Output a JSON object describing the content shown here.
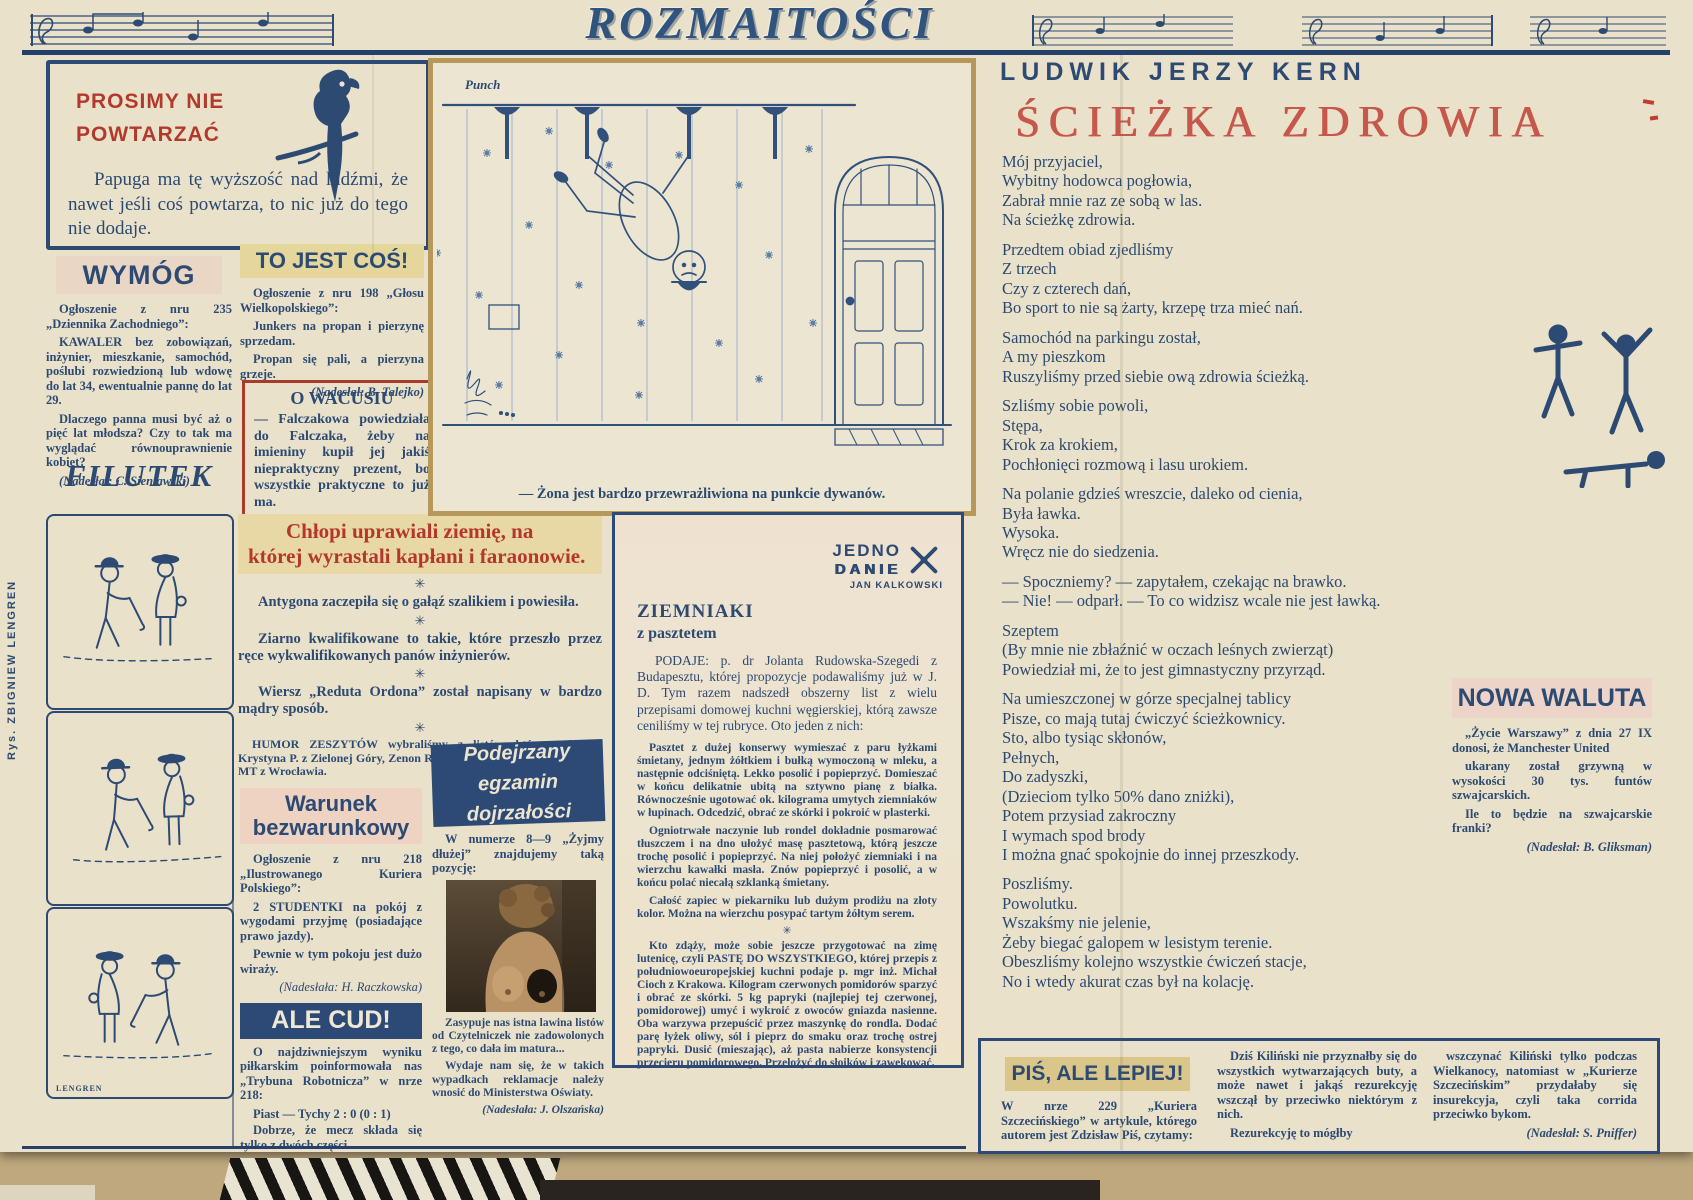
{
  "masthead": {
    "title": "ROZMAITOŚCI"
  },
  "no_repeat": {
    "title": "PROSIMY NIE\nPOWTARZAĆ",
    "body": "Papuga ma tę wyższość nad ludźmi, że nawet jeśli coś powtarza, to nic już do tego nie dodaje."
  },
  "wymog": {
    "title": "WYMÓG",
    "p1": "Ogłoszenie z nru 235 „Dziennika Zachodniego”:",
    "p2": "KAWALER bez zobowiązań, inżynier, mieszkanie, samochód, poślubi rozwiedzioną lub wdowę do lat 34, ewentualnie pannę do lat 29.",
    "p3": "Dlaczego panna musi być aż o pięć lat młodsza? Czy to tak ma wyglądać równouprawnienie kobiet?",
    "credit": "(Nadesłał: C. Sieniawski)"
  },
  "filutek": {
    "title": "FILUTEK",
    "signature": "LENGREN",
    "side_credit": "Rys. ZBIGNIEW LENGREN"
  },
  "to_jest_cos": {
    "title": "TO JEST COŚ!",
    "p1": "Ogłoszenie z nru 198 „Głosu Wielkopolskiego”:",
    "p2": "Junkers na propan i pierzynę sprzedam.",
    "p3": "Propan się pali, a pierzyna grzeje.",
    "credit": "(Nadesłał: B. Talejko)"
  },
  "o_wacusiu": {
    "title": "O WACUSIU",
    "body": "— Falczakowa powiedziała do Falczaka, żeby na imieniny kupił jej jakiś niepraktyczny prezent, bo wszystkie praktyczne to już ma."
  },
  "chlopi": {
    "title": "Chłopi uprawiali ziemię, na której wyrastali kapłani i faraonowie.",
    "star": "✳",
    "item1": "Antygona zaczepiła się o gałąź szalikiem i powiesiła.",
    "item2": "Ziarno kwalifikowane to takie, które przeszło przez ręce wykwalifikowanych panów inżynierów.",
    "item3": "Wiersz „Reduta Ordona” został napisany w bardzo mądry sposób.",
    "humor": "HUMOR ZESZYTÓW wybraliśmy z listów, które nadesłali: Krystyna P. z Zielonej Góry, Zenon R. z Łap, Ilona C. z Blachowni Śl., MT z Wrocławia.",
    "thanks": "Dziękujemy."
  },
  "warunek": {
    "title": "Warunek\nbezwarunkowy",
    "p1": "Ogłoszenie z nru 218 „Ilustrowanego Kuriera Polskiego”:",
    "p2": "2 STUDENTKI na pokój z wygodami przyjmę (posiadające prawo jazdy).",
    "p3": "Pewnie w tym pokoju jest dużo wiraży.",
    "credit": "(Nadesłała: H. Raczkowska)"
  },
  "ale_cud": {
    "title": "ALE CUD!",
    "p1": "O najdziwniejszym wyniku piłkarskim poinformowała nas „Trybuna Robotnicza” w nrze 218:",
    "score": "Piast — Tychy 2 : 0 (0 : 1)",
    "p2": "Dobrze, że mecz składa się tylko z dwóch części.",
    "credit": "(Nadesłał: M. Klos)"
  },
  "podejrzany": {
    "title": "Podejrzany\negzamin dojrzałości",
    "p1": "W numerze 8—9 „Żyjmy dłużej” znajdujemy taką pozycję:",
    "p2": "Zasypuje nas istna lawina listów od Czytelniczek nie zadowolonych z tego, co dała im matura...",
    "p3": "Wydaje nam się, że w takich wypadkach reklamacje należy wnosić do Ministerstwa Oświaty.",
    "credit": "(Nadesłała: J. Olszańska)"
  },
  "cartoon": {
    "source": "Punch",
    "caption": "— Żona jest bardzo przewrażliwiona na punkcie dywanów."
  },
  "jedno_danie": {
    "logo_line1": "JEDNO",
    "logo_line2": "DANIE",
    "logo_author": "JAN KALKOWSKI",
    "title": "ZIEMNIAKI",
    "subtitle": "z pasztetem",
    "intro": "PODAJE: p. dr Jolanta Rudowska-Szegedi z Budapesztu, której propozycje podawaliśmy już w J. D. Tym razem nadszedł obszerny list z wielu przepisami domowej kuchni węgierskiej, którą zawsze ceniliśmy w tej rubryce. Oto jeden z nich:",
    "r1": "Pasztet z dużej konserwy wymieszać z paru łyżkami śmietany, jednym żółtkiem i bułką wymoczoną w mleku, a następnie odciśniętą. Lekko posolić i popieprzyć. Domieszać w końcu delikatnie ubitą na sztywno pianę z białka. Równocześnie ugotować ok. kilograma umytych ziemniaków w łupinach. Odcedzić, obrać ze skórki i pokroić w plasterki.",
    "r2": "Ogniotrwałe naczynie lub rondel dokładnie posmarować tłuszczem i na dno ułożyć masę pasztetową, którą jeszcze trochę posolić i popieprzyć. Na niej położyć ziemniaki i na wierzchu kawałki masła. Znów popieprzyć i posolić, a w końcu polać niecałą szklanką śmietany.",
    "r3": "Całość zapiec w piekarniku lub dużym prodiżu na złoty kolor. Można na wierzchu posypać tartym żółtym serem.",
    "star": "✳",
    "r4": "Kto zdąży, może sobie jeszcze przygotować na zimę lutenicę, czyli PASTĘ DO WSZYSTKIEGO, której przepis z południowoeuropejskiej kuchni podaje p. mgr inż. Michał Cioch z Krakowa. Kilogram czerwonych pomidorów sparzyć i obrać ze skórki. 5 kg papryki (najlepiej tej czerwonej, pomidorowej) umyć i wykroić z owoców gniazda nasienne. Oba warzywa przepuścić przez maszynkę do rondla. Dodać parę łyżek oliwy, sól i pieprz do smaku oraz trochę ostrej papryki. Dusić (mieszając), aż pasta nabierze konsystencji przecieru pomidorowego. Przełożyć do słoików i zawekować."
  },
  "poem": {
    "author": "LUDWIK JERZY KERN",
    "title": "ŚCIEŻKA ZDROWIA",
    "stanzas": [
      "Mój przyjaciel,\nWybitny hodowca pogłowia,\nZabrał mnie raz ze sobą w las.\nNa ścieżkę zdrowia.",
      "Przedtem obiad zjedliśmy\nZ trzech\nCzy z czterech dań,\nBo sport to nie są żarty, krzepę trza mieć nań.",
      "Samochód na parkingu został,\nA my pieszkom\nRuszyliśmy przed siebie ową zdrowia ścieżką.",
      "Szliśmy sobie powoli,\nStępa,\nKrok za krokiem,\nPochłonięci rozmową i lasu urokiem.",
      "Na polanie gdzieś wreszcie, daleko od cienia,\nByła ławka.\nWysoka.\nWręcz nie do siedzenia.",
      "— Spoczniemy? — zapytałem, czekając na brawko.\n— Nie! — odparł. — To co widzisz wcale nie jest ławką.",
      "Szeptem\n(By mnie nie zbłaźnić w oczach leśnych zwierząt)\nPowiedział mi, że to jest gimnastyczny przyrząd.",
      "Na umieszczonej w górze specjalnej tablicy\nPisze, co mają tutaj ćwiczyć ścieżkownicy.\nSto, albo tysiąc skłonów,\nPełnych,\nDo zadyszki,\n(Dzieciom tylko 50% dano zniżki),\nPotem przysiad zakroczny\nI wymach spod brody\nI można gnać spokojnie do innej przeszkody.",
      "Poszliśmy.\nPowolutku.\nWszakśmy nie jelenie,\nŻeby biegać galopem w lesistym terenie.\nObeszliśmy kolejno wszystkie ćwiczeń stacje,\nNo i wtedy akurat czas był na kolację."
    ]
  },
  "nowa_waluta": {
    "title": "NOWA WALUTA",
    "p1": "„Życie Warszawy” z dnia 27 IX donosi, że Manchester United",
    "p2": "ukarany został grzywną w wysokości 30 tys. funtów szwajcarskich.",
    "p3": "Ile to będzie na szwajcarskie franki?",
    "credit": "(Nadesłał: B. Gliksman)"
  },
  "pis": {
    "title": "PIŚ, ALE LEPIEJ!",
    "col1": "W nrze 229 „Kuriera Szczecińskiego” w artykule, którego autorem jest Zdzisław Piś, czytamy:",
    "col2a": "Dziś Kiliński nie przyznałby się do wszystkich wytwarzających buty, a może nawet i jakąś rezurekcyję wszczął by przeciwko niektórym z nich.",
    "col2b": "Rezurekcyję to mógłby",
    "col3": "wszczynać Kiliński tylko podczas Wielkanocy, natomiast w „Kurierze Szczecińskim” przydałaby się insurekcyja, czyli taka corrida przeciwko bykom.",
    "credit": "(Nadesłał: S. Pniffer)"
  }
}
